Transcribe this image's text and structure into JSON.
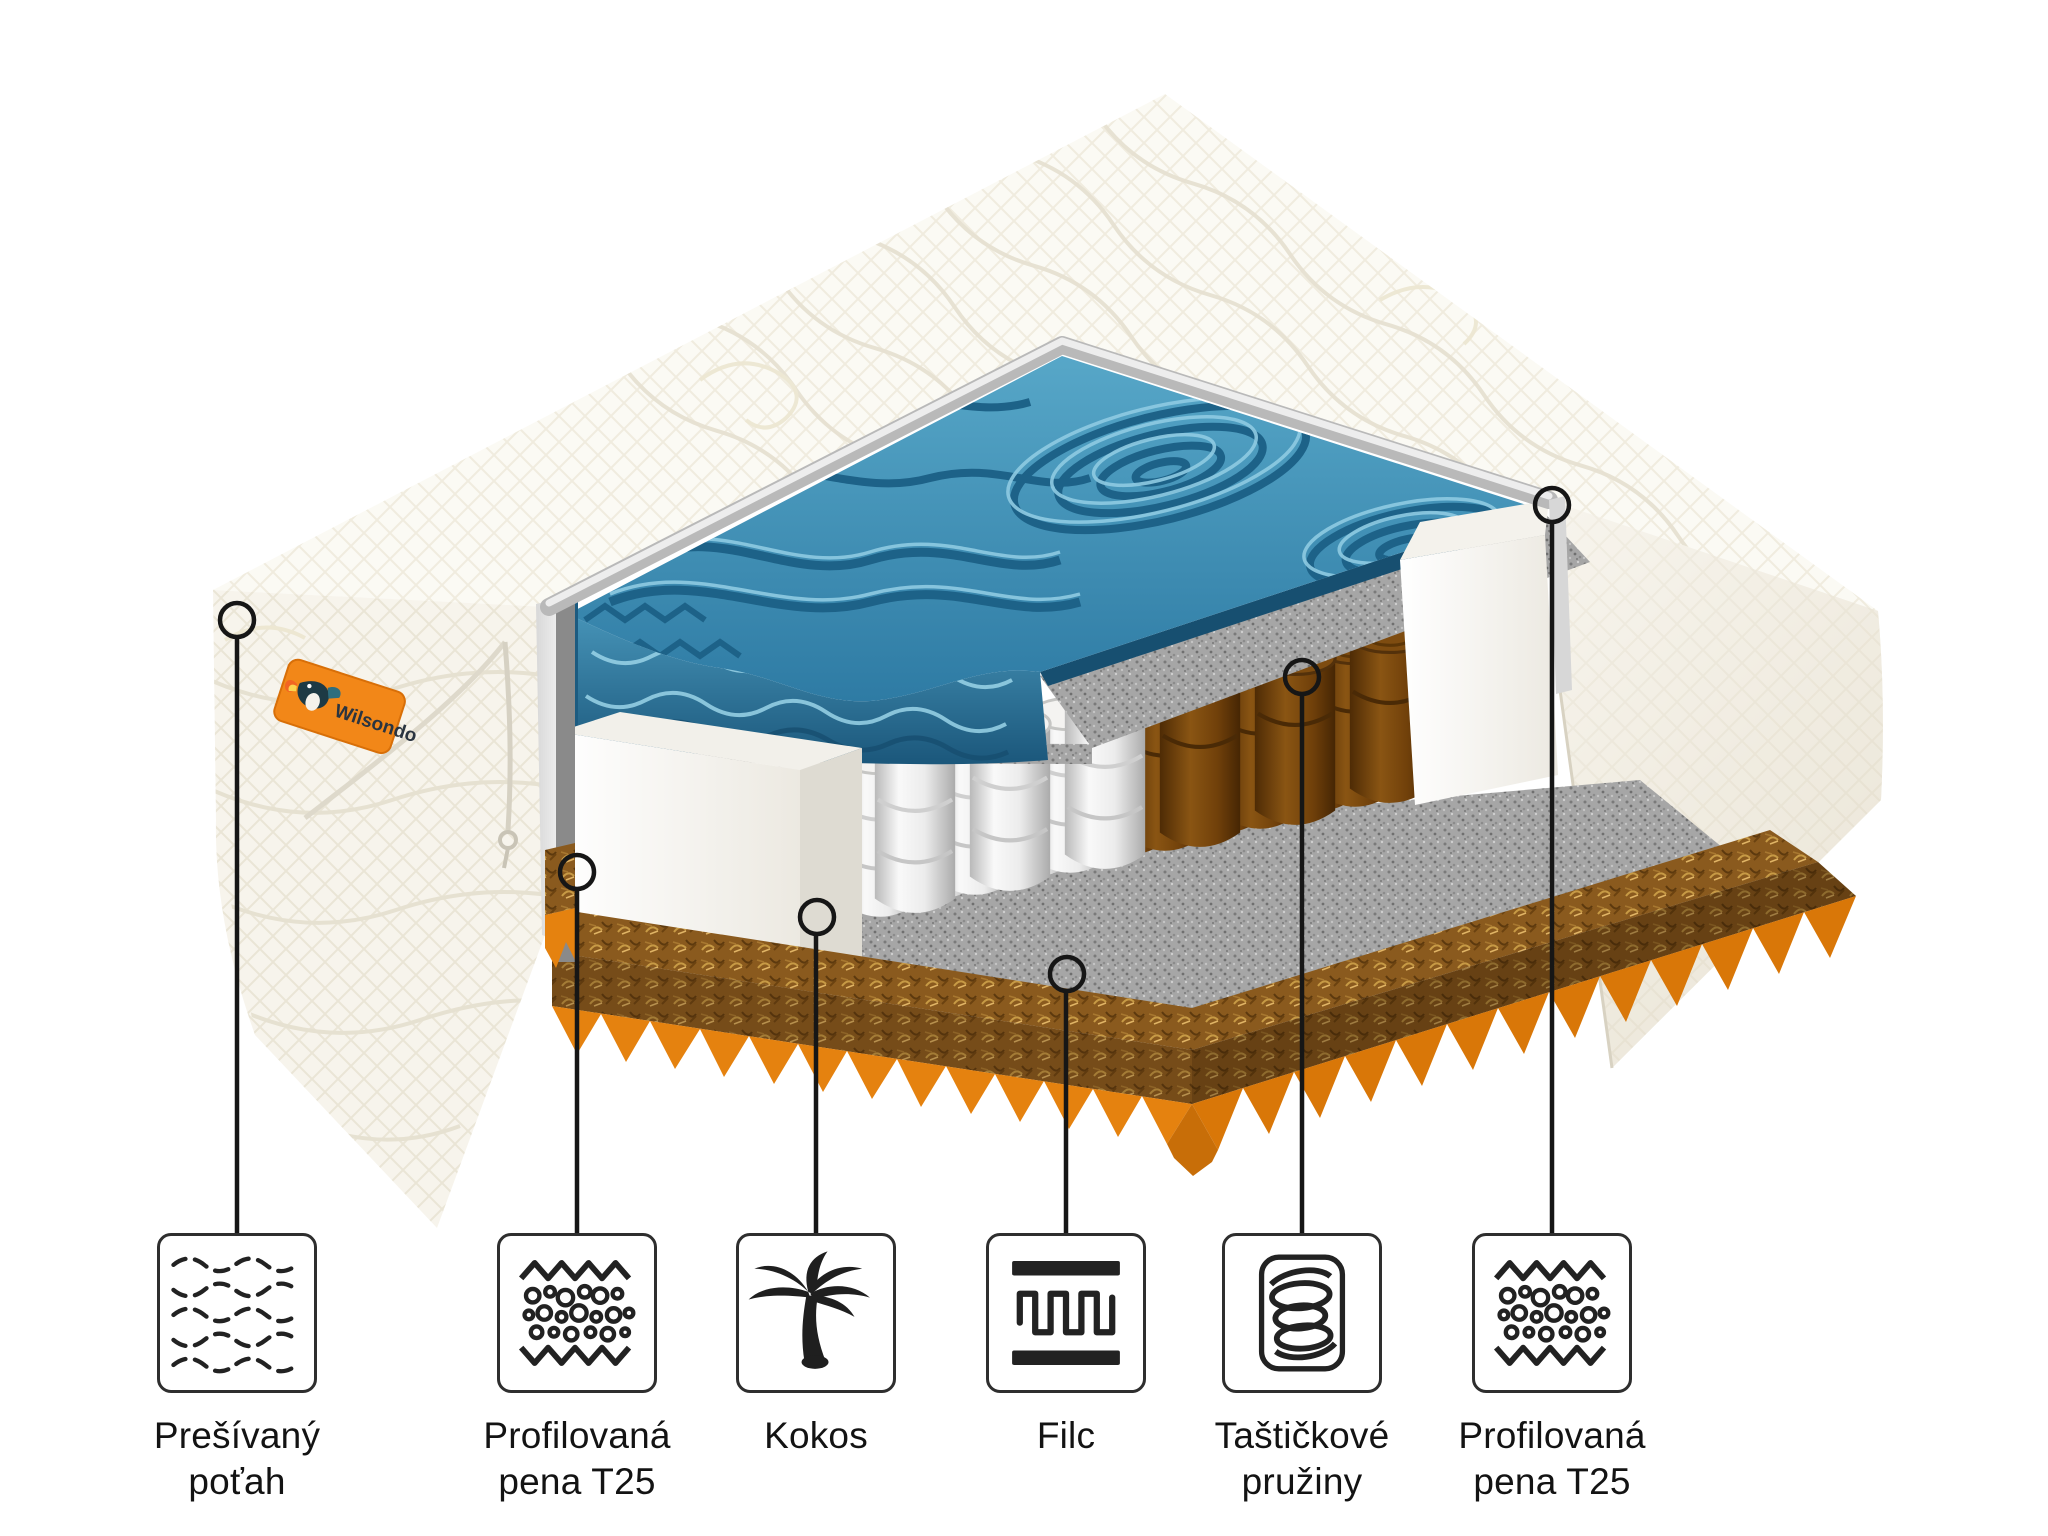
{
  "brand": {
    "name": "Wilsondo",
    "tag_color": "#F28718",
    "tag_text_color": "#2A3440"
  },
  "legend": {
    "items": [
      {
        "label": "Prešívaný poťah",
        "icon": "quilted-cover-icon"
      },
      {
        "label": "Profilovaná pena T25",
        "icon": "profiled-foam-icon"
      },
      {
        "label": "Kokos",
        "icon": "coconut-palm-icon"
      },
      {
        "label": "Filc",
        "icon": "felt-icon"
      },
      {
        "label": "Taštičkové pružiny",
        "icon": "pocket-springs-icon"
      },
      {
        "label": "Profilovaná pena T25",
        "icon": "profiled-foam-icon"
      }
    ]
  },
  "palette": {
    "foam_top_blue": "#3E8CB4",
    "foam_bottom_orange": "#E5820F",
    "coconut_board": "#8A5A1E",
    "felt_gray": "#A6A6A6",
    "spring_white": "#F2F2F2",
    "spring_coconut": "#7E4C10",
    "cover_white": "#FAF8F2"
  }
}
